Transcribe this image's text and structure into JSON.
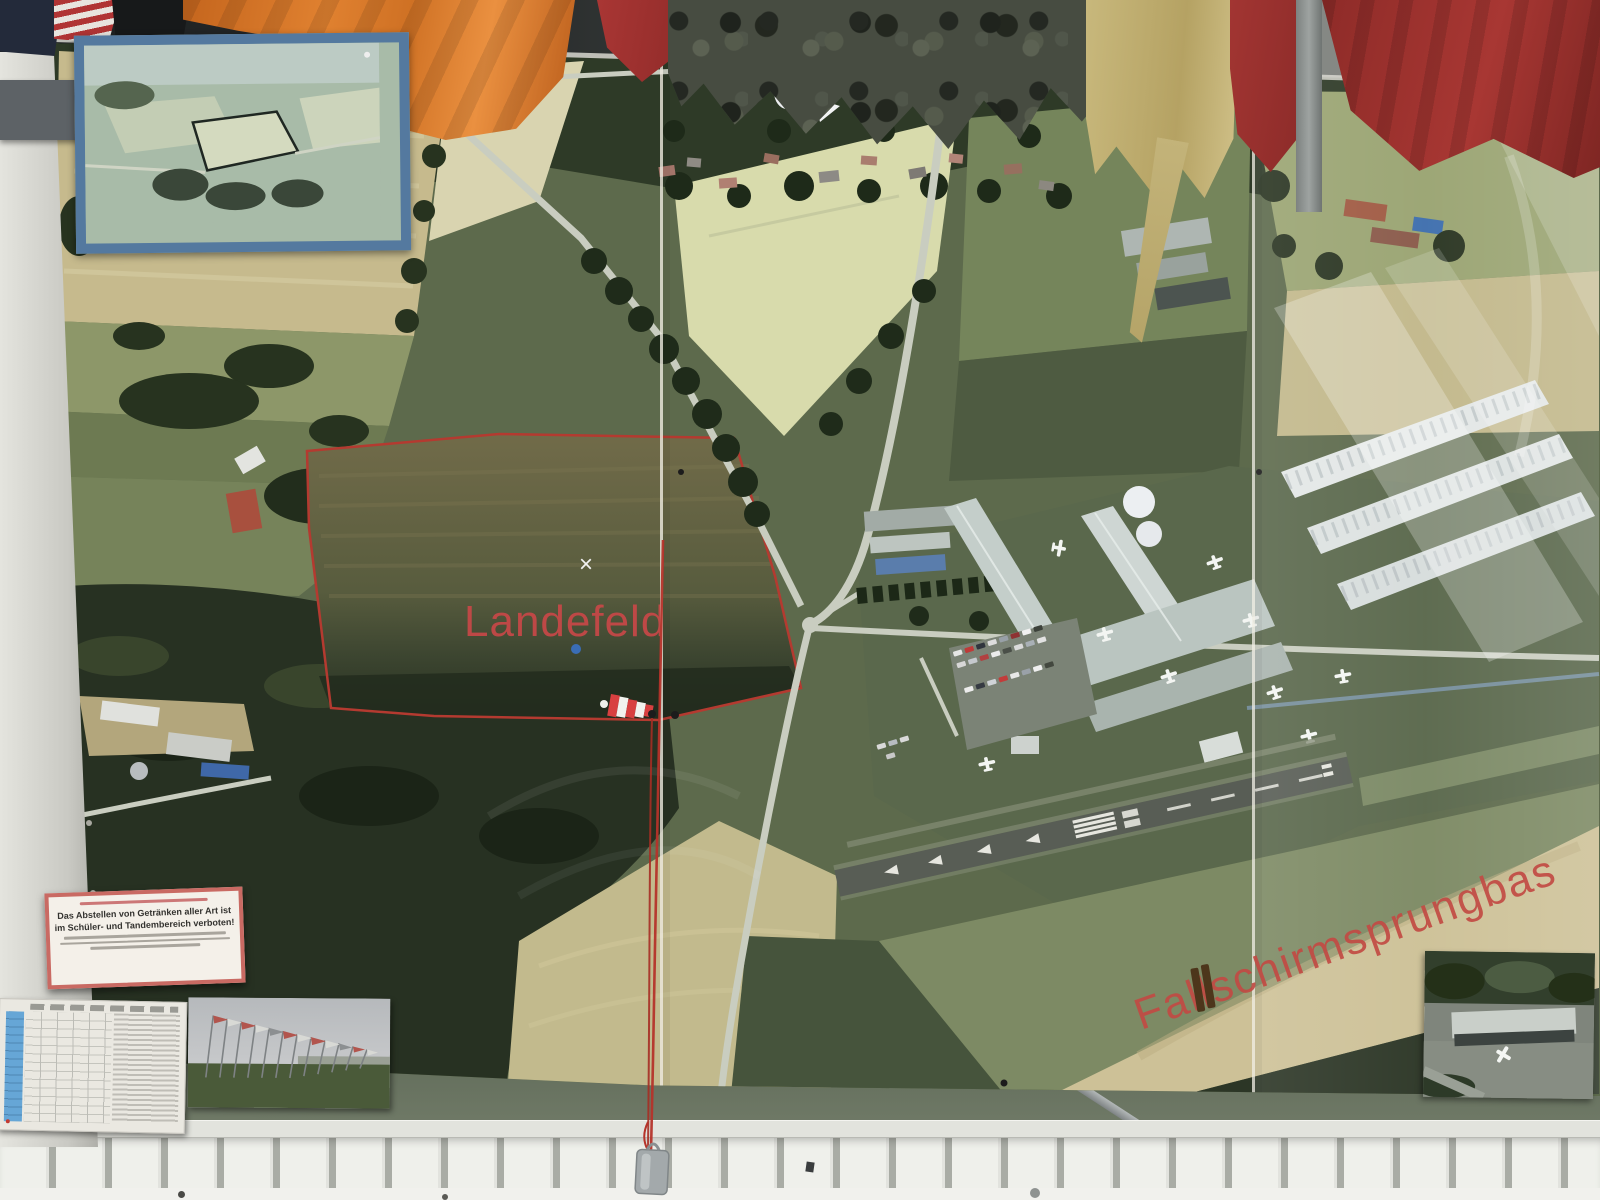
{
  "labels": {
    "landing_field": "Landefeld",
    "jump_base": "Fallschirmsprungbas",
    "x_marker": "×"
  },
  "warning_sign": {
    "line1": "Das Abstellen von Getränken aller Art ist",
    "line2": "im Schüler- und Tandembereich verboten!"
  },
  "colors": {
    "label_red": "#c84848",
    "boundary_red": "#b43a30",
    "inset_border_blue": "#54799f",
    "orange_flag": "#d8792a",
    "camouflage": "#474c41",
    "german_gold": "#c3b379",
    "flag_red": "#a23532",
    "runway_gray": "#585d55",
    "wall_panel_white": "#eff0eb",
    "field_tan": "#c6ba8d",
    "field_green": "#75855b",
    "woods_dark": "#273122"
  },
  "icons": {
    "windsock-icon": "red/white striped cone marker",
    "x-marker-icon": "white cross on landing field",
    "parachute-icon": "white canopy graphic",
    "aircraft-icon": "white small-plane silhouette",
    "plumb-weight-icon": "gray weight hanging on red cord"
  }
}
